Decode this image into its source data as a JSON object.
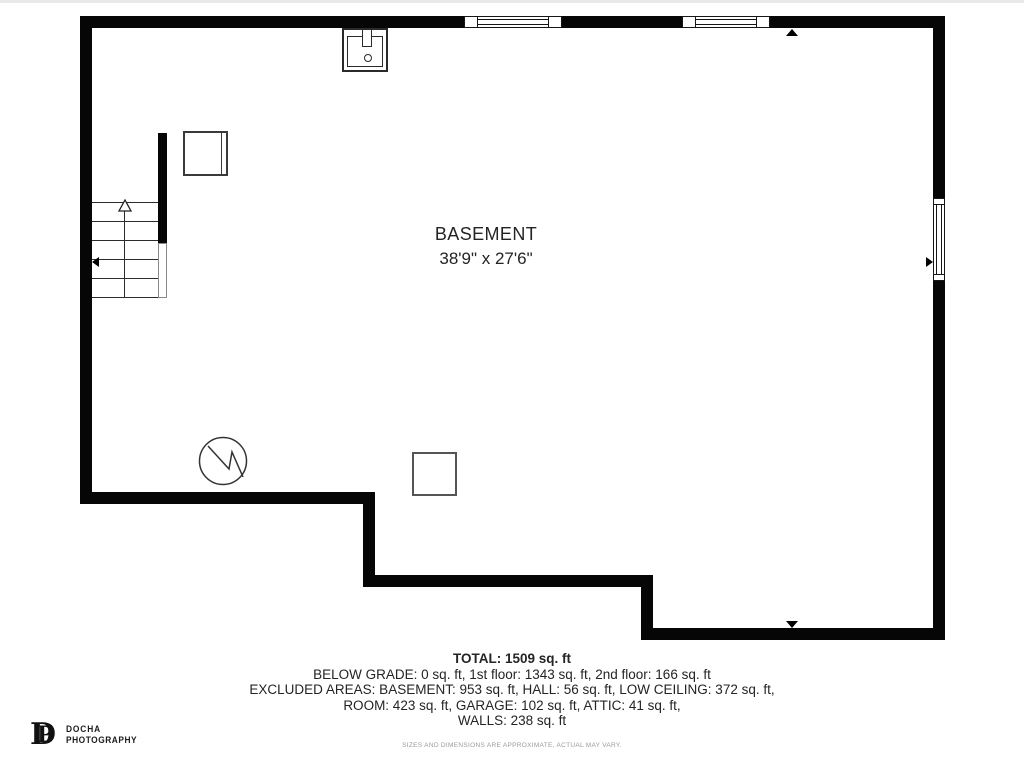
{
  "floorplan": {
    "room_label": {
      "name": "BASEMENT",
      "dimensions": "38'9\" x 27'6\""
    },
    "summary": {
      "total": "TOTAL: 1509 sq. ft",
      "below_grade_line": "BELOW GRADE: 0 sq. ft, 1st floor: 1343 sq. ft, 2nd floor: 166 sq. ft",
      "excluded_line1": "EXCLUDED AREAS: BASEMENT: 953 sq. ft, HALL: 56 sq. ft, LOW CEILING: 372 sq. ft,",
      "excluded_line2": "ROOM: 423 sq. ft, GARAGE: 102 sq. ft, ATTIC: 41 sq. ft,",
      "walls_line": "WALLS: 238 sq. ft",
      "disclaimer": "SIZES AND DIMENSIONS ARE APPROXIMATE, ACTUAL MAY VARY."
    },
    "logo": {
      "monogram_d": "D",
      "monogram_p": "P",
      "brand_line1": "DOCHA",
      "brand_line2": "PHOTOGRAPHY"
    },
    "icons": {
      "sink": "sink-icon",
      "water_heater": "water-heater-icon",
      "stairs_up_arrow": "stairs-up-arrow-icon",
      "direction_markers": "direction-marker-icon"
    },
    "colors": {
      "wall": "#060606",
      "thin_line": "#2c2c2c",
      "text": "#242424",
      "muted_text": "#9a9a9a",
      "background": "#ffffff"
    }
  }
}
